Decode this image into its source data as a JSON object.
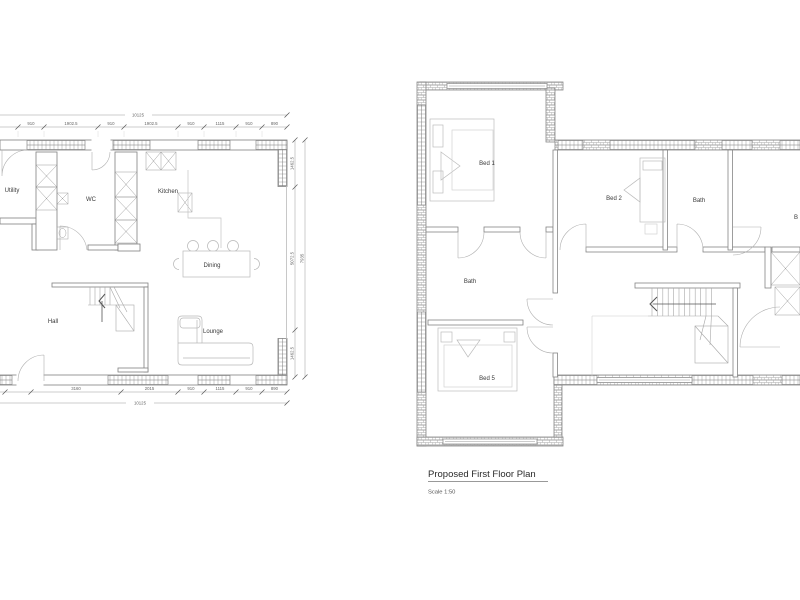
{
  "drawing": {
    "type": "architectural-floor-plans",
    "background": "#ffffff",
    "colors": {
      "wall_line": "#808080",
      "light_line": "#c0c0c0",
      "hatch": "#a8a8a8",
      "text": "#3a3a3a",
      "dim_text": "#666666"
    }
  },
  "ground_floor": {
    "rooms": {
      "utility": "Utility",
      "wc": "WC",
      "kitchen": "Kitchen",
      "dining": "Dining",
      "hall": "Hall",
      "lounge": "Lounge"
    },
    "dims": {
      "top_total": "10125",
      "top_segments": [
        "910",
        "1902.5",
        "910",
        "1902.5",
        "910",
        "1115",
        "910",
        "890"
      ],
      "bottom_segments": [
        "3160",
        "2015",
        "910",
        "1115",
        "910",
        "890"
      ],
      "bottom_total": "10125",
      "right_segments": [
        "1462.5",
        "5072.5",
        "1462.5"
      ],
      "right_total": "7935"
    }
  },
  "first_floor": {
    "rooms": {
      "bed1": "Bed 1",
      "bed2": "Bed 2",
      "bath_top": "Bath",
      "bed_right_partial": "B",
      "bath_mid": "Bath",
      "bed5": "Bed 5"
    },
    "title": "Proposed First Floor Plan",
    "scale": "Scale 1:50"
  }
}
